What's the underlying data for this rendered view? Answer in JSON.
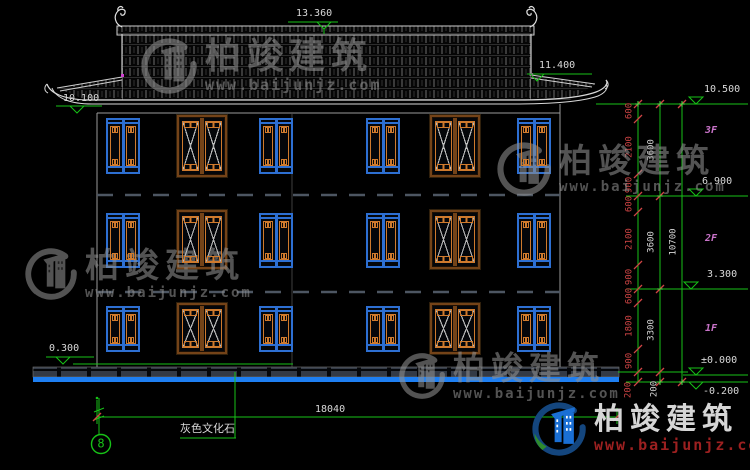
{
  "watermark": {
    "brand": "柏竣建筑",
    "site": "www.baijunjz.com"
  },
  "elevations": {
    "ridge": "13.360",
    "right_eave": "11.400",
    "left_eave": "10.100",
    "plinth": "0.300",
    "levels": [
      "10.500",
      "6.900",
      "3.300",
      "±0.000",
      "-0.200"
    ]
  },
  "floors": [
    "3F",
    "2F",
    "1F"
  ],
  "dims": {
    "inner": [
      "600",
      "2100",
      "900",
      "600",
      "2100",
      "900",
      "600",
      "1800",
      "900",
      "200"
    ],
    "mid": [
      "3600",
      "3600",
      "3300",
      "200"
    ],
    "outer": [
      "10700"
    ],
    "total_width": "18040"
  },
  "labels": {
    "material": "灰色文化石",
    "axis": "8"
  },
  "colors": {
    "line_green": "#17c217",
    "dim_red": "#d04545",
    "text_white": "#d9d9d9",
    "floor_magenta": "#c873c8",
    "window_blue": "#2d6fd2",
    "window_orange": "#cf7a2d",
    "ground_blue": "#1e7ff2",
    "watermark_gray": "#909090",
    "brand_blue": "#1a6fd4",
    "brand_green": "#2e8b2e",
    "brand_red": "#9c2020"
  }
}
